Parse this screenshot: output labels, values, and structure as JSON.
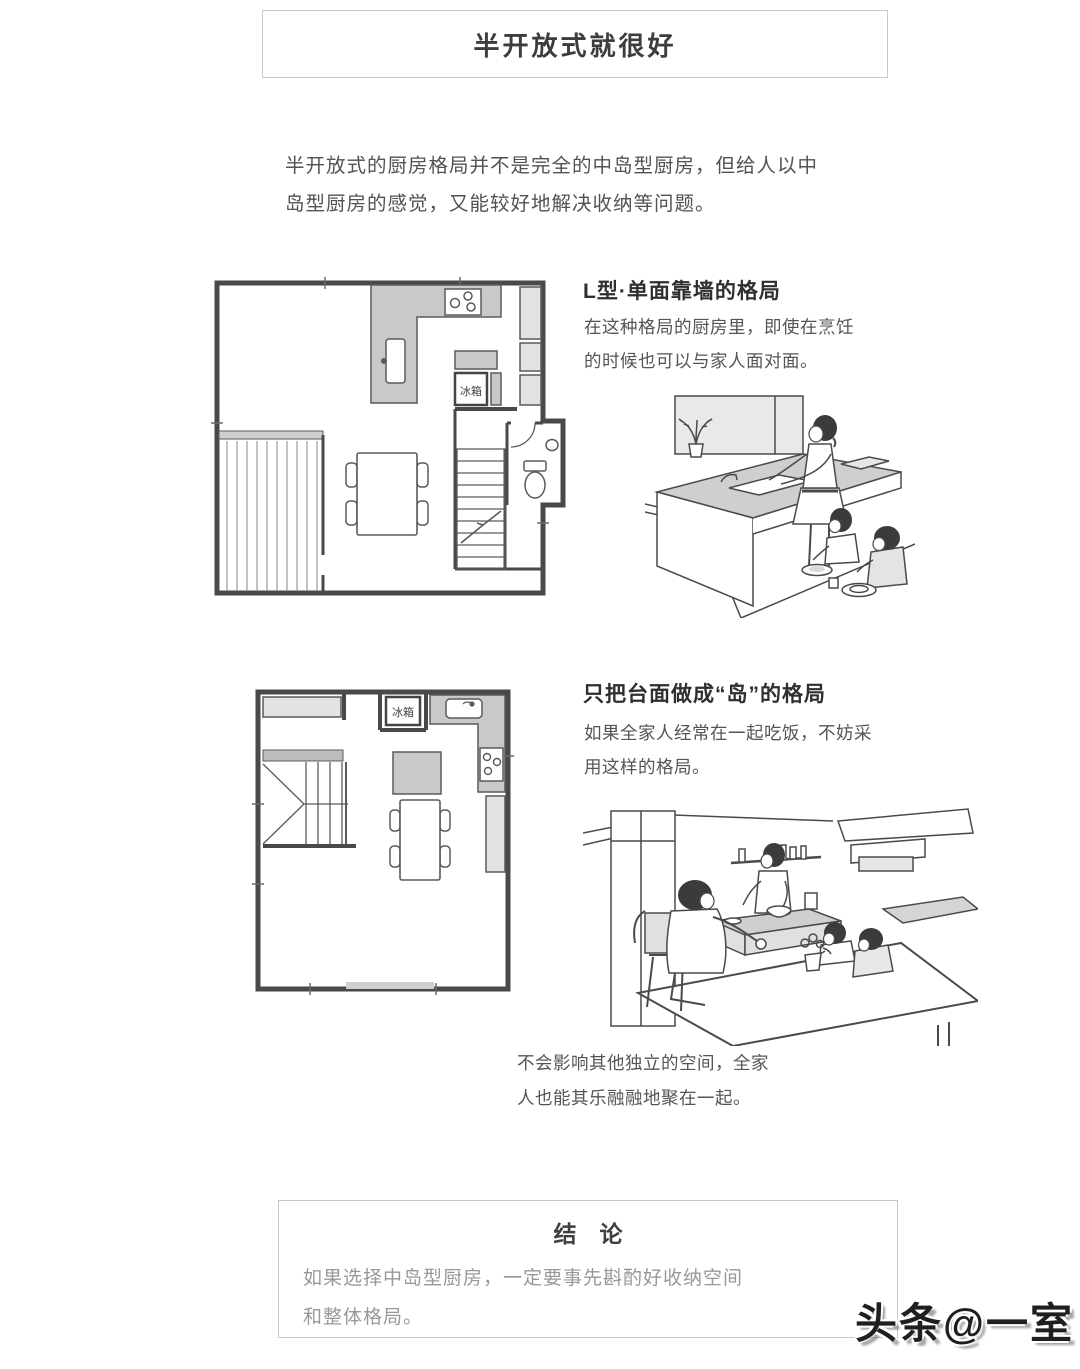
{
  "header": {
    "title": "半开放式就很好"
  },
  "intro": {
    "lines": [
      "半开放式的厨房格局并不是完全的中岛型厨房，但给人以中",
      "岛型厨房的感觉，又能较好地解决收纳等问题。"
    ]
  },
  "section1": {
    "heading": "L型·单面靠墙的格局",
    "body_lines": [
      "在这种格局的厨房里，即使在烹饪",
      "的时候也可以与家人面对面。"
    ],
    "plan": {
      "fridge_label": "冰箱"
    }
  },
  "section2": {
    "heading": "只把台面做成“岛”的格局",
    "body_lines": [
      "如果全家人经常在一起吃饭，不妨采",
      "用这样的格局。"
    ],
    "plan": {
      "fridge_label": "冰箱"
    },
    "caption_lines": [
      "不会影响其他独立的空间，全家",
      "人也能其乐融融地聚在一起。"
    ]
  },
  "conclusion": {
    "title": "结　论",
    "body_lines": [
      "如果选择中岛型厨房，一定要事先斟酌好收纳空间",
      "和整体格局。"
    ]
  },
  "watermark": {
    "text": "头条@一室"
  },
  "colors": {
    "counter_gray": "#c9c9c9",
    "cabinet_gray": "#e3e3e3",
    "wall_line": "#494949",
    "box_border": "#c8c8c8",
    "text_dark": "#3d3d3d",
    "text_body": "#555555",
    "text_muted": "#98989b"
  }
}
